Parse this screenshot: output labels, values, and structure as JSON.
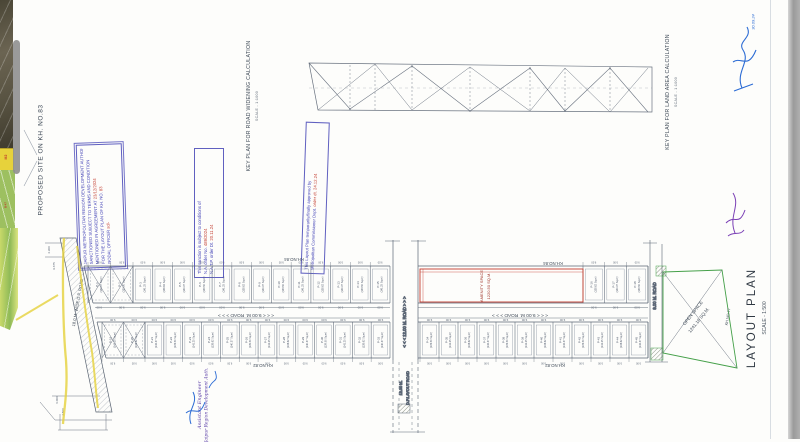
{
  "titles": {
    "proposed_site": "PROPOSED SITE ON  KH. NO.83",
    "key_road": "KEY PLAN FOR ROAD WIDENING CALCULATION",
    "key_road_scale": "SCALE - 1:1000",
    "key_land": "KEY PLAN FOR LAND AREA CALCULATION",
    "key_land_scale": "SCALE - 1:1000",
    "layout": "LAYOUT PLAN",
    "layout_scale": "SCALE - 1:500"
  },
  "stamps": {
    "authority": {
      "lines": [
        {
          "t": "JAIPUR METROPOLITAN REGION DEVELOPMENT AUTHORITY",
          "r": ""
        },
        {
          "t": "SANCTIONED SUBJECT TO TERMS AND CONDITION",
          "r": ""
        },
        {
          "t": "MENTIONED IN AGREEMENT AT ",
          "r": "23/12/2024"
        },
        {
          "t": "FOR THE LAYOUT PLAN OF KH. NO. ",
          "r": "83"
        },
        {
          "t": "NODAL OFFICER ",
          "r": "sd/-"
        }
      ]
    },
    "sanction": {
      "lines": [
        {
          "t": "This sanction is subject to conditions of",
          "r": ""
        },
        {
          "t": "N.A. order No. ",
          "r": "489/2024"
        },
        {
          "t": "N.A.T.P. order Dt. ",
          "r": "20.11.24"
        }
      ]
    },
    "approval": {
      "lines": [
        {
          "t": "This Layout Plan temporarily/finally approved by",
          "r": ""
        },
        {
          "t": "Metropolitan Commissioner Dept. ",
          "r": "order dt. 24.12.24"
        }
      ]
    }
  },
  "roads": {
    "mid": "< < <  9.00 M. ROAD  > > >",
    "cross": "< < <  12.00 M. ROAD  > > >",
    "cross2a": "12.00 M.",
    "cross2b": "D.P.LAYOUT ROAD",
    "right": "9.00 M. ROAD",
    "left_dp": "18.0 M. WIDE D.P. ROAD"
  },
  "kh": {
    "k84": "KH.NO.84",
    "k82": "KH.NO.82",
    "k77": "KH.NO.77"
  },
  "amenity": {
    "name": "AMENITY SPACE",
    "area": "1220.50 SQ.M."
  },
  "open_space": {
    "name": "OPEN SPACE",
    "area": "1241.16 SQ.M."
  },
  "map": {
    "m2": "M2",
    "b47": "B-47"
  },
  "handwriting": {
    "role1": "Assistant Engineer",
    "role2": "Jaipur Region Development Auth.",
    "date": "30.09.24"
  },
  "dims": {
    "cell": "9.00",
    "left": [
      "4.300",
      "9.675",
      "6.000",
      "4.500"
    ]
  },
  "plots": {
    "area_samples": [
      "140.37",
      "139.50",
      "141.25",
      "138.62"
    ],
    "area_suffix": "Sq.m",
    "top_x": [
      "P-1",
      "P-2"
    ],
    "top_a": [
      "P-3",
      "P-4",
      "P-5",
      "P-6",
      "P-7",
      "P-8",
      "P-9",
      "P-10",
      "P-11",
      "P-12",
      "P-13",
      "P-14",
      "P-15"
    ],
    "top_b": [
      "P-16",
      "P-17",
      "P-18"
    ],
    "bot_x": [
      "P-19",
      "P-20"
    ],
    "bot_a": [
      "P-21",
      "P-22",
      "P-23",
      "P-24",
      "P-25",
      "P-26",
      "P-27",
      "P-28",
      "P-29",
      "P-30",
      "P-31",
      "P-32",
      "P-33"
    ],
    "bot_b": [
      "P-34",
      "P-35",
      "P-36",
      "P-37",
      "P-38",
      "P-39",
      "P-40",
      "P-41",
      "P-42",
      "P-43",
      "P-44",
      "P-45"
    ]
  }
}
